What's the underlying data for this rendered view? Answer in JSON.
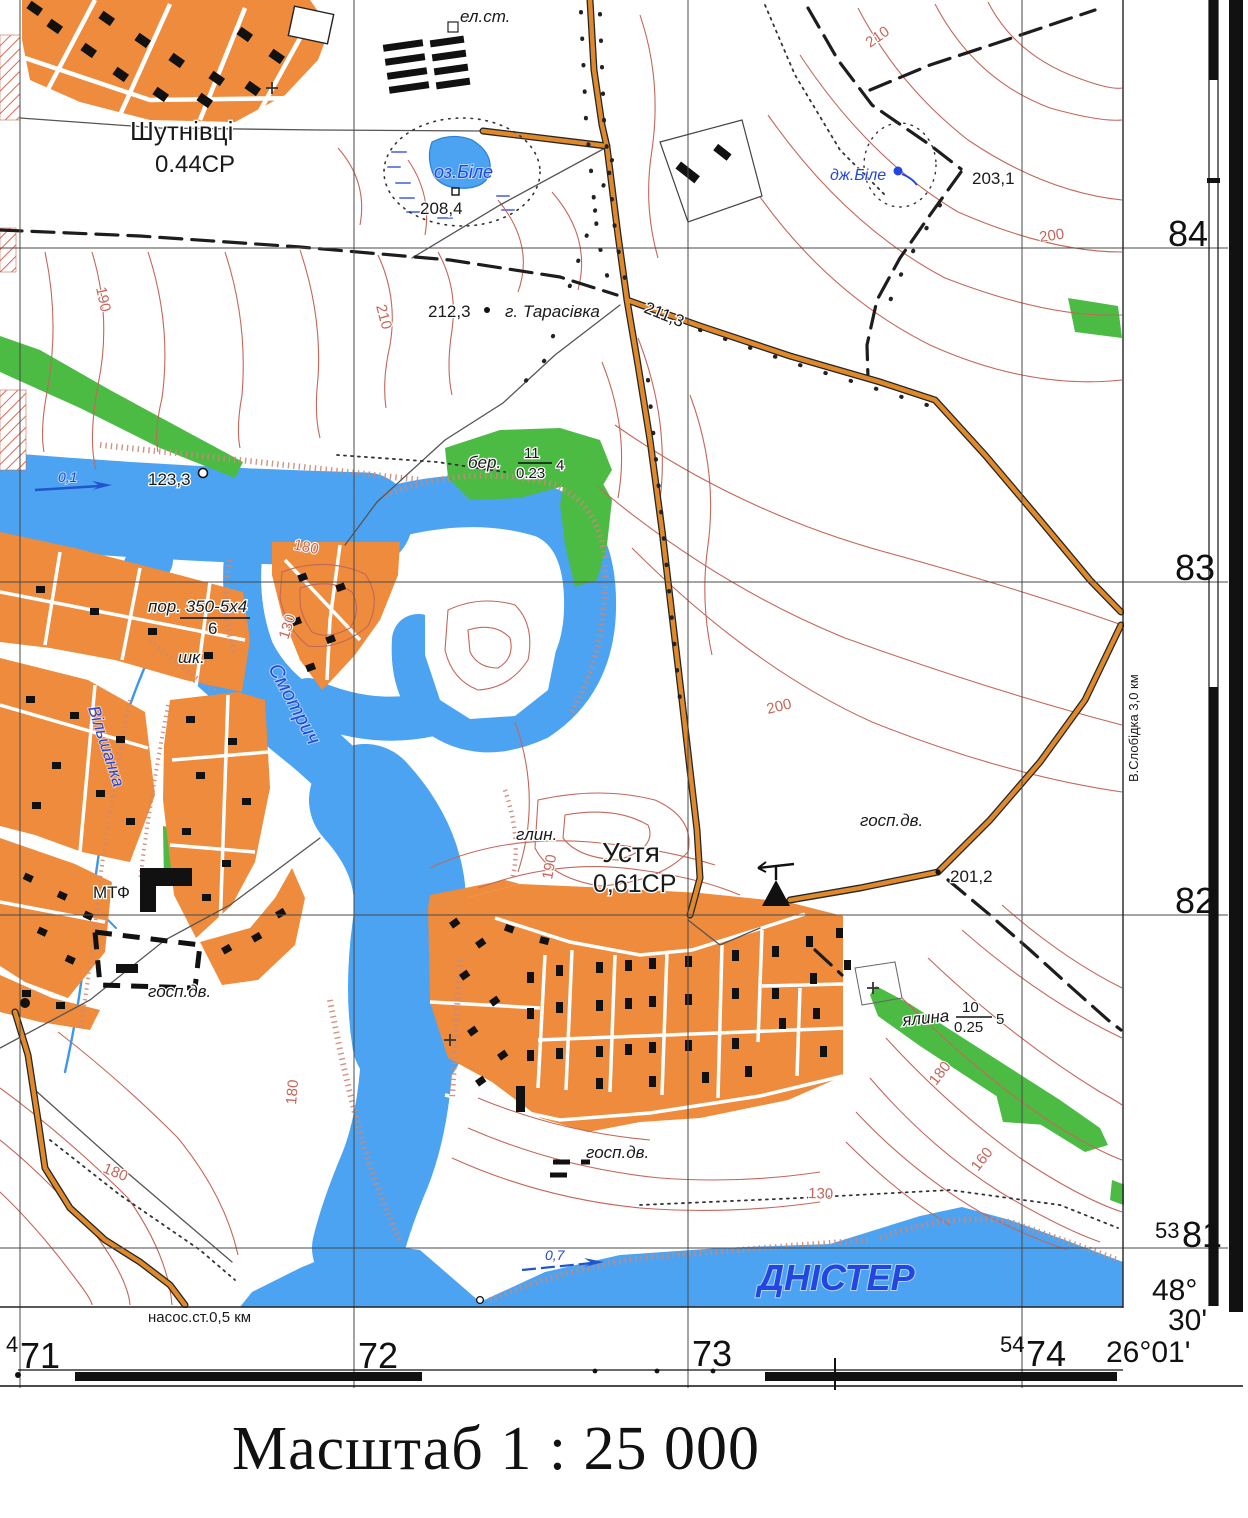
{
  "caption": "Масштаб 1 : 25 000",
  "colors": {
    "water": "#4BA3F2",
    "water-text": "#2446E0",
    "settlement": "#EE8B3C",
    "forest": "#4CBB44",
    "contour": "#C4675A",
    "road": "#E0892B",
    "casing": "#262626",
    "grid": "#4a4a4a",
    "hachure": "#CC8877"
  },
  "labels": {
    "shutnivtsi": "Шутнівці",
    "shutnivtsi_info": "0.44СР",
    "ustia": "Устя",
    "ustia_info": "0,61СР",
    "el_st": "ел.ст.",
    "lake": "оз.Біле",
    "lake_elev": "208,4",
    "spring": "дж.Біле",
    "spring_elev": "203,1",
    "hill_elev": "212,3",
    "hill": "г. Тарасівка",
    "road_elev": "211,3",
    "birch": "бер.",
    "birch_num": "11",
    "birch_den": "0.23",
    "birch_extra": "4",
    "spruce": "ялина",
    "spruce_num": "10",
    "spruce_den": "0.25",
    "spruce_extra": "5",
    "rapids": "пор. 350-5x4",
    "rapids_den": "6",
    "school": "шк.",
    "clay": "глин.",
    "mtf": "МТФ",
    "gosp_dv": "госп.дв.",
    "river_smotrych": "Смотрич",
    "river_vilshanka": "Вільшанка",
    "river_dnister": "ДНІСТЕР",
    "flow1": "0,1",
    "flow2": "0,7",
    "spot_123": "123,3",
    "spot_201": "201,2",
    "c210": "210",
    "c200": "200",
    "c190": "190",
    "c180": "180",
    "c160": "160",
    "c130": "130",
    "pump": "насос.ст.0,5 км",
    "slobidka": "В.Слобідка 3,0 км"
  },
  "frame": {
    "northings": [
      {
        "prefix": "",
        "value": "84"
      },
      {
        "prefix": "",
        "value": "83"
      },
      {
        "prefix": "",
        "value": "82"
      },
      {
        "prefix": "53",
        "value": "81"
      }
    ],
    "eastings": [
      {
        "prefix": "4",
        "value": "71"
      },
      {
        "prefix": "",
        "value": "72"
      },
      {
        "prefix": "",
        "value": "73"
      },
      {
        "prefix": "54",
        "value": "74"
      }
    ],
    "corner": {
      "lat_deg": "48°",
      "lat_min": "30'",
      "lon": "26°01'"
    }
  }
}
